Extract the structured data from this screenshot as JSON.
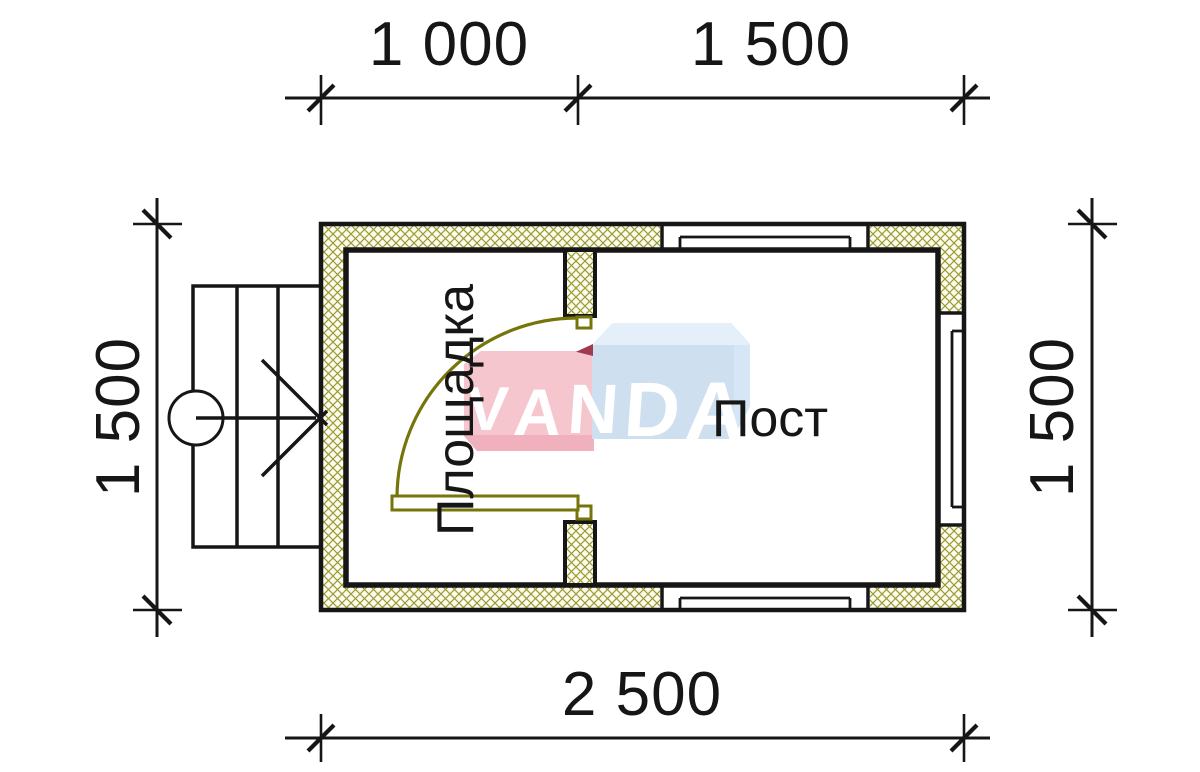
{
  "title": "Floor plan 2500x1500 with porch and post room",
  "colors": {
    "label": "#161616",
    "line": "#161616",
    "hatch": "#9a9a31",
    "hatch_bg": "#fcfcf1",
    "door": "#75750a",
    "logo_pink": "#f6c6cf",
    "logo_pink_dark": "#f1b0bd",
    "logo_red_fold": "#a03a50",
    "logo_blue": "#d7e6f4",
    "logo_blue_dark": "#c6d8ec",
    "logo_blue_light": "#e4effa",
    "logo_text": "#ffffff"
  },
  "dimensions": {
    "top_left": "1 000",
    "top_right": "1 500",
    "left_side": "1 500",
    "right_side": "1 500",
    "bottom": "2 500"
  },
  "rooms": {
    "porch": "Площадка",
    "post": "Пост"
  },
  "logo": {
    "text": "VANDA",
    "letters": [
      "V",
      "A",
      "N",
      "D",
      "A"
    ]
  }
}
